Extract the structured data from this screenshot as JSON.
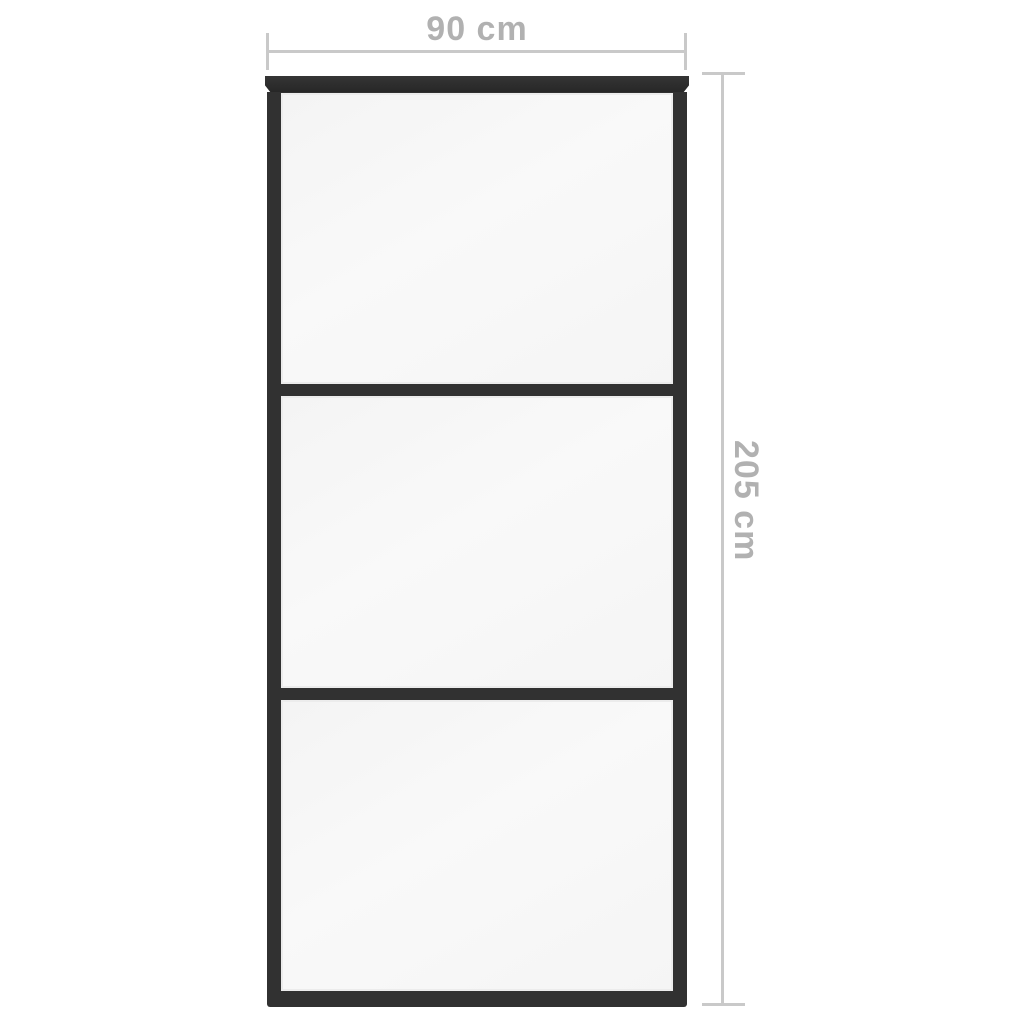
{
  "diagram": {
    "kind": "product-dimension-diagram",
    "subject": "sliding-door-with-three-glass-panels",
    "door": {
      "panel_count": 3,
      "frame_color": "#313131",
      "glass_color": "#f7f7f7"
    },
    "background_color": "#ffffff"
  },
  "dimensions": {
    "width": {
      "label": "90 cm",
      "value": 90,
      "unit": "cm"
    },
    "height": {
      "label": "205 cm",
      "value": 205,
      "unit": "cm"
    }
  },
  "annotation_style": {
    "line_color": "#c9c9c9",
    "text_color": "#b1b1b1"
  }
}
